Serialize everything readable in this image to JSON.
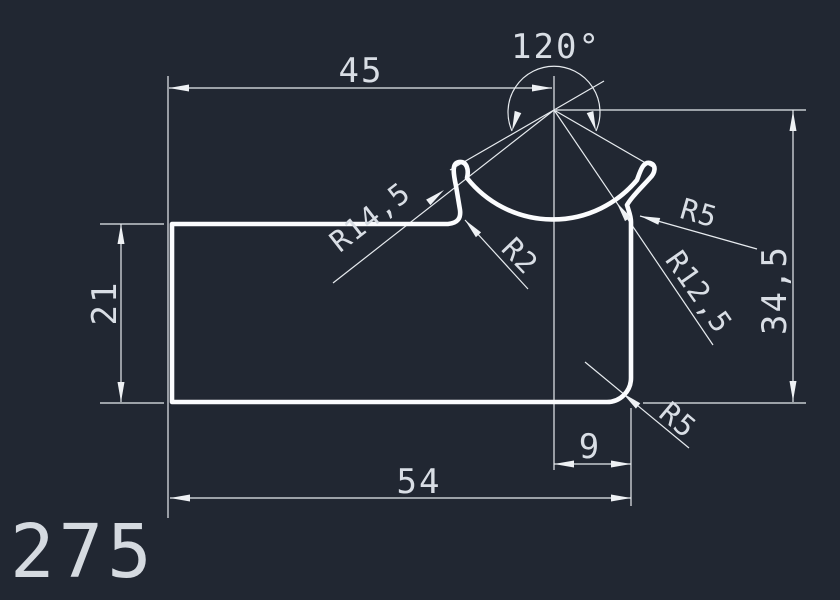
{
  "canvas": {
    "background_color": "#212732",
    "profile_line_color": "#fbfcfe",
    "dimension_line_color": "#e7ebef",
    "text_color": "#d9dee5"
  },
  "drawing": {
    "part_label": "275",
    "dims": {
      "top_width": "45",
      "angle": "120°",
      "left_height": "21",
      "right_height": "34,5",
      "right_offset": "9",
      "bottom_width": "54"
    },
    "radii": {
      "groove_outer": "R14,5",
      "lip_inner": "R2",
      "hook_right": "R5",
      "groove_inner": "R12,5",
      "corner_bottom": "R5"
    }
  }
}
